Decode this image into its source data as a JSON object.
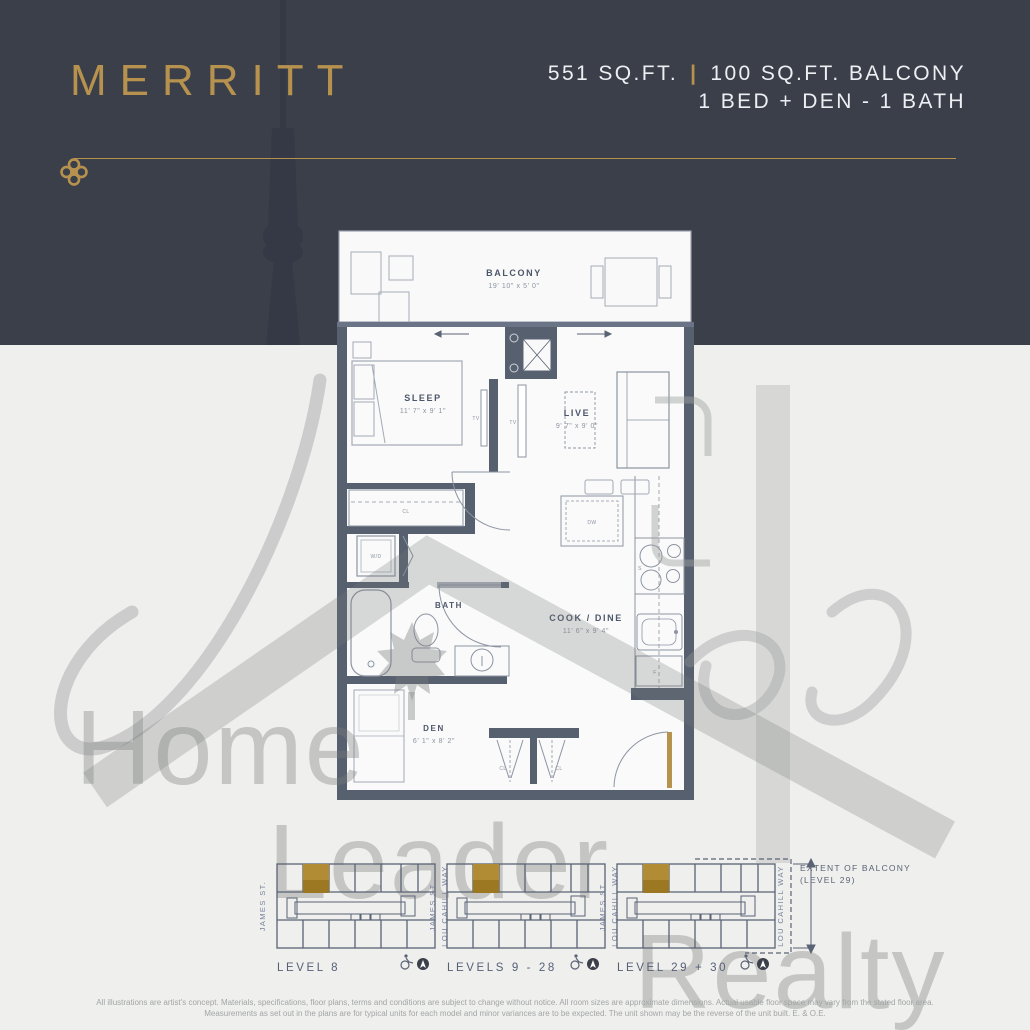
{
  "header": {
    "title": "MERRITT",
    "area": "551 SQ.FT.",
    "separator": "|",
    "balcony_area": "100 SQ.FT. BALCONY",
    "layout": "1 BED + DEN - 1 BATH"
  },
  "colors": {
    "header_navy": "#3a3f4a",
    "gold": "#b6924e",
    "wall_slate": "#57606f",
    "background": "#efefed"
  },
  "floorplan": {
    "rooms": {
      "balcony": {
        "name": "BALCONY",
        "dims": "19' 10\" x 5' 0\""
      },
      "sleep": {
        "name": "SLEEP",
        "dims": "11' 7\" x 9' 1\""
      },
      "live": {
        "name": "LIVE",
        "dims": "9' 7\" x 9' 0\""
      },
      "bath": {
        "name": "BATH"
      },
      "cook": {
        "name": "COOK / DINE",
        "dims": "11' 6\" x 9' 4\""
      },
      "den": {
        "name": "DEN",
        "dims": "6' 1\" x 8' 2\""
      }
    },
    "fixtures": {
      "tv": "TV",
      "washer_dryer": "W/D",
      "dishwasher": "DW",
      "stove": "S",
      "fridge": "F",
      "closet": "CL"
    }
  },
  "keyplans": {
    "left_street": "JAMES ST.",
    "right_street": "LOU CAHILL WAY",
    "plans": [
      {
        "label": "LEVEL 8"
      },
      {
        "label": "LEVELS 9 - 28"
      },
      {
        "label": "LEVEL 29 + 30"
      }
    ],
    "balcony_note_line1": "EXTENT OF BALCONY",
    "balcony_note_line2": "(LEVEL 29)"
  },
  "watermark": {
    "word1": "Home",
    "word2": "Leader",
    "word3": "Realty"
  },
  "disclaimer": {
    "line1": "All illustrations are artist's concept. Materials, specifications, floor plans, terms and conditions are subject to change without notice. All room sizes are approximate dimensions. Actual usable floor space may vary from the stated floor area.",
    "line2": "Measurements as set out in the plans are for typical units for each model and minor variances are to be expected. The unit shown may be the reverse of the unit built. E. & O.E."
  }
}
